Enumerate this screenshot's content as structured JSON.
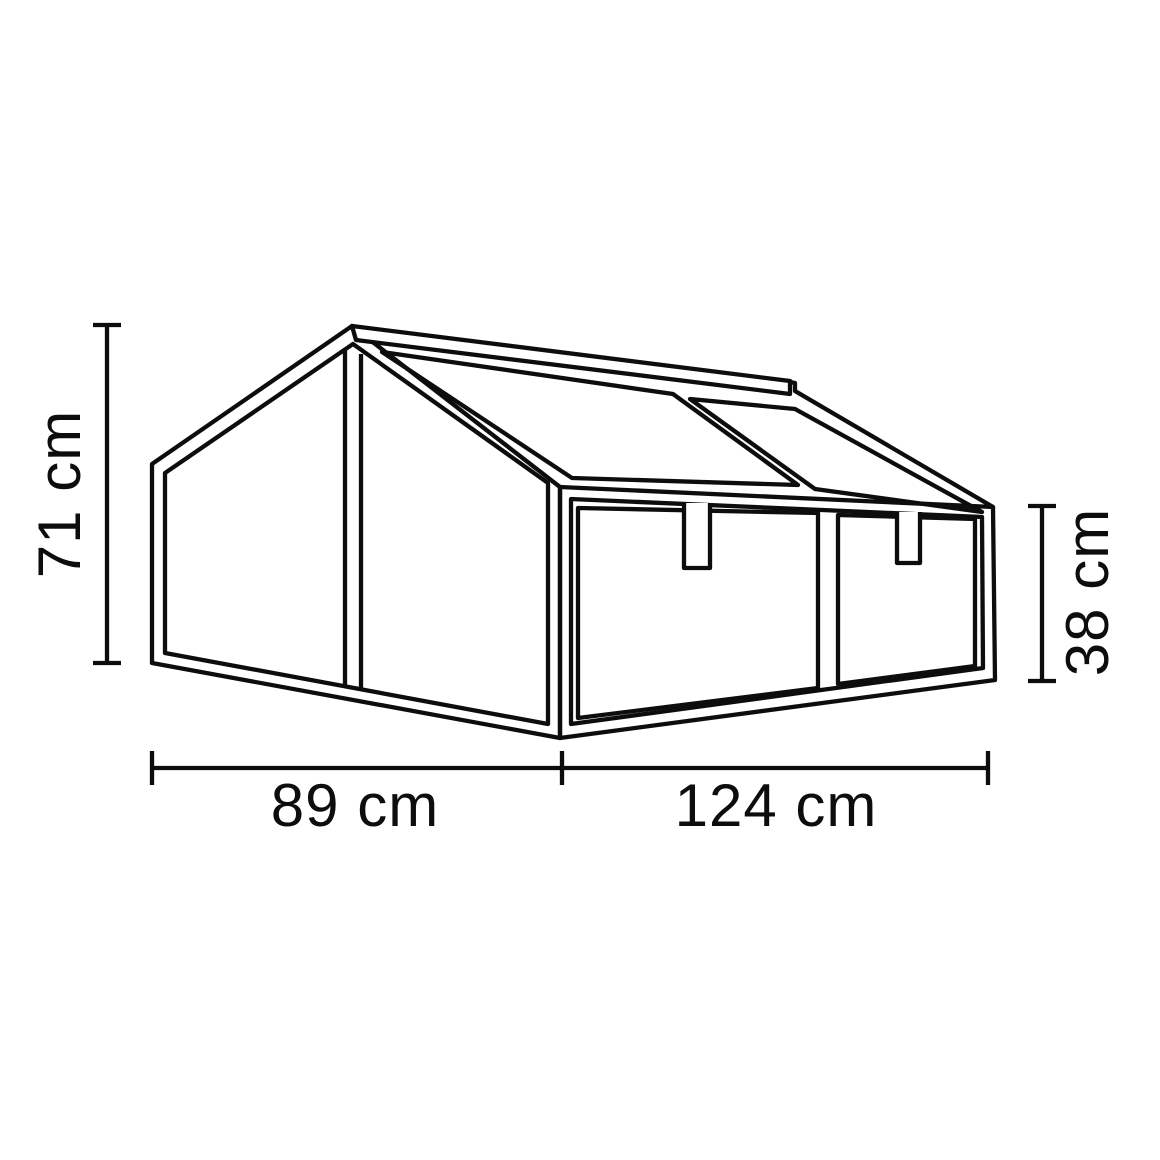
{
  "figure": {
    "type": "technical-dimension-drawing",
    "subject": "cold frame greenhouse with sloped twin glass lids, two front panels and gable end",
    "background_color": "#ffffff",
    "line_color": "#0d0d0d"
  },
  "dimensions": {
    "back_height": {
      "label": "71 cm",
      "value": 71,
      "unit": "cm",
      "orientation": "vertical",
      "position": "left"
    },
    "front_height": {
      "label": "38 cm",
      "value": 38,
      "unit": "cm",
      "orientation": "vertical",
      "position": "right"
    },
    "side_depth": {
      "label": "89 cm",
      "value": 89,
      "unit": "cm",
      "orientation": "horizontal",
      "position": "bottom-left"
    },
    "front_width": {
      "label": "124 cm",
      "value": 124,
      "unit": "cm",
      "orientation": "horizontal",
      "position": "bottom-right"
    }
  }
}
